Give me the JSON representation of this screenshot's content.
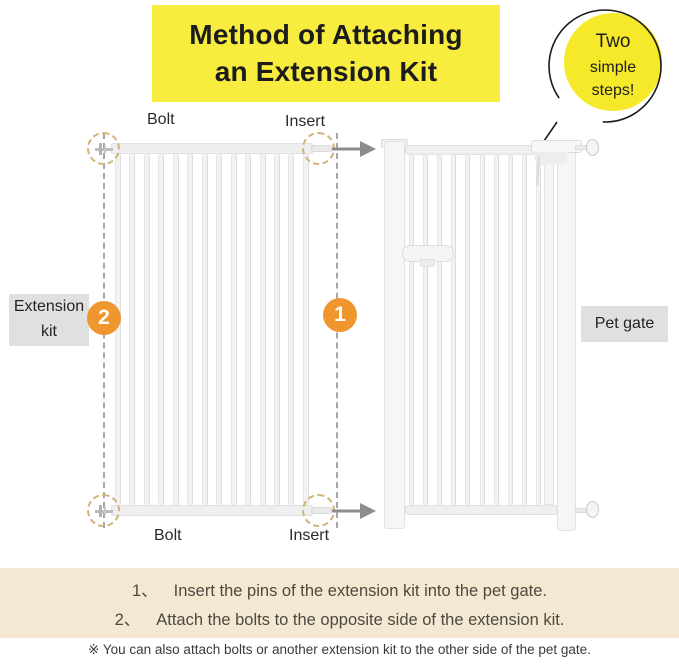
{
  "title": {
    "line1": "Method of Attaching",
    "line2": "an Extension Kit"
  },
  "bubble": {
    "line1": "Two",
    "line2": "simple",
    "line3": "steps!"
  },
  "diagram": {
    "bolt_top_label": "Bolt",
    "insert_top_label": "Insert",
    "bolt_bottom_label": "Bolt",
    "insert_bottom_label": "Insert",
    "extension_kit_label_line1": "Extension",
    "extension_kit_label_line2": "kit",
    "pet_gate_label": "Pet gate",
    "badge_step1": "1",
    "badge_step2": "2"
  },
  "steps": [
    {
      "num": "1、",
      "text": "Insert the pins of the extension kit into the pet gate."
    },
    {
      "num": "2、",
      "text": "Attach the bolts to the opposite side of the extension kit."
    }
  ],
  "note": "※ You can also attach bolts or another extension kit to the other side of the pet gate.",
  "colors": {
    "title_bg": "#f8ec3f",
    "bubble_bg": "#f6e929",
    "badge_orange": "#f0962e",
    "steps_band_bg": "#f5e8d2",
    "label_box_bg": "#e0e0e0",
    "arrow_gray": "#8c8c8c",
    "dashed_circle_tan": "#d2b378"
  }
}
